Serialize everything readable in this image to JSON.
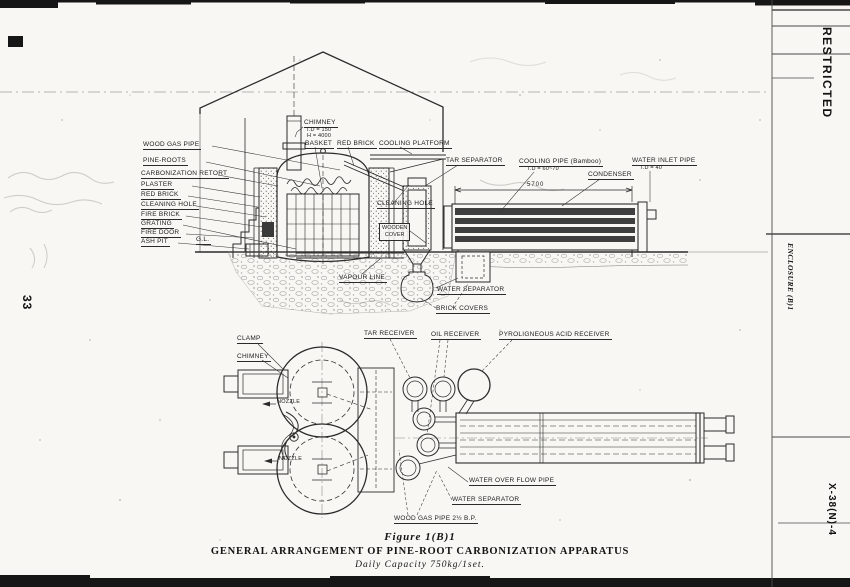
{
  "margins": {
    "restricted": "RESTRICTED",
    "enclosure": "ENCLOSURE (B)1",
    "doc_number": "X-38(N)-4",
    "page_number": "33"
  },
  "elevation": {
    "left_labels": [
      "WOOD GAS PIPE",
      "PINE-ROOTS",
      "CARBONIZATION RETORT",
      "PLASTER",
      "RED BRICK",
      "CLEANING HOLE",
      "FIRE BRICK",
      "GRATING",
      "FIRE DOOR",
      "ASH PIT"
    ],
    "ground_level": "G.L.",
    "chimney_label": "CHIMNEY",
    "chimney_dim1": "I.D = 150",
    "chimney_dim2": "H = 4000",
    "basket": "BASKET",
    "red_brick": "RED BRICK",
    "cooling_platform": "COOLING PLATFORM",
    "tar_separator": "TAR SEPARATOR",
    "cooling_pipe_label": "COOLING PIPE (Bamboo)",
    "cooling_pipe_dim": "I.D = 60~70",
    "condenser": "CONDENSER",
    "water_inlet_label": "WATER INLET PIPE",
    "water_inlet_dim": "I.D = 40",
    "condenser_length_dim": "5700",
    "cleaning_hole": "CLEANING HOLE",
    "wooden_cover_line1": "WOODEN",
    "wooden_cover_line2": "COVER",
    "vapour_line": "VAPOUR LINE",
    "water_separator": "WATER SEPARATOR",
    "brick_covers": "BRICK COVERS"
  },
  "plan": {
    "clamp": "CLAMP",
    "chimney": "CHIMNEY",
    "nozzle1": "NOZZLE",
    "nozzle2": "NOZZLE",
    "tar_receiver": "TAR RECEIVER",
    "oil_receiver": "OIL RECEIVER",
    "pyroligneous_receiver": "PYROLIGNEOUS ACID RECEIVER",
    "water_overflow": "WATER OVER FLOW PIPE",
    "water_separator": "WATER SEPARATOR",
    "wood_gas_pipe": "WOOD GAS PIPE 2½ B.P."
  },
  "caption": {
    "figure": "Figure 1(B)1",
    "title": "GENERAL ARRANGEMENT OF PINE-ROOT CARBONIZATION APPARATUS",
    "subtitle": "Daily Capacity 750kg/1set."
  }
}
